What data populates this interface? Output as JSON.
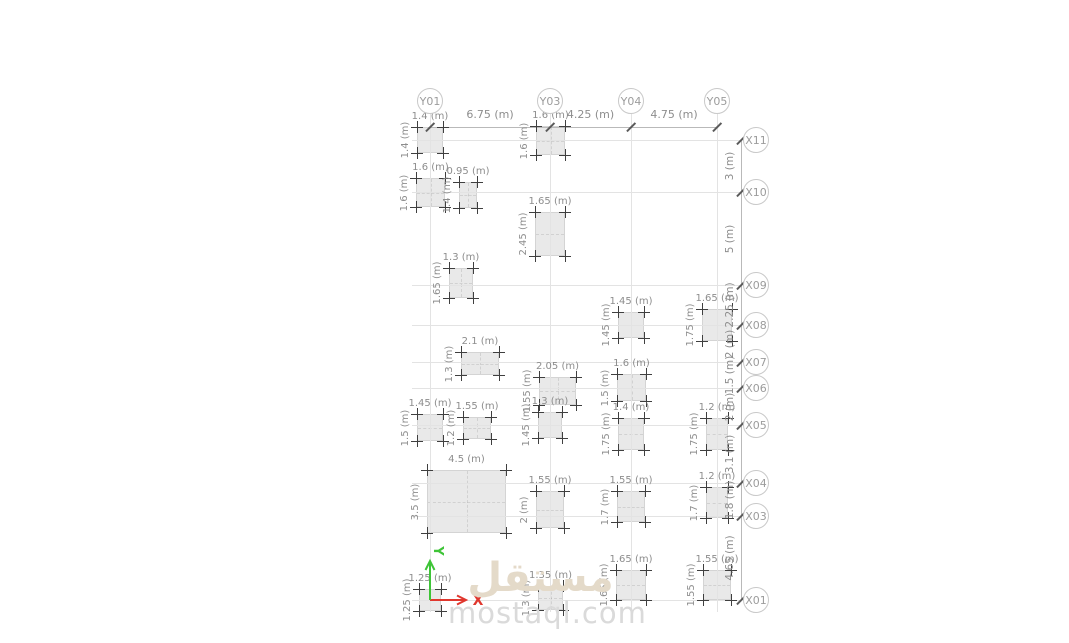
{
  "drawing": {
    "columns": [
      {
        "label": "Y01",
        "x": 430
      },
      {
        "label": "Y03",
        "x": 550
      },
      {
        "label": "Y04",
        "x": 631
      },
      {
        "label": "Y05",
        "x": 717
      }
    ],
    "rows": [
      {
        "label": "X11",
        "y": 140
      },
      {
        "label": "X10",
        "y": 192
      },
      {
        "label": "X09",
        "y": 285
      },
      {
        "label": "X08",
        "y": 325
      },
      {
        "label": "X07",
        "y": 362
      },
      {
        "label": "X06",
        "y": 388
      },
      {
        "label": "X05",
        "y": 425
      },
      {
        "label": "X04",
        "y": 483
      },
      {
        "label": "X03",
        "y": 516
      },
      {
        "label": "X01",
        "y": 600
      }
    ],
    "top_dimensions": [
      {
        "label": "6.75 (m)",
        "from_x": 430,
        "to_x": 550
      },
      {
        "label": "4.25 (m)",
        "from_x": 550,
        "to_x": 631
      },
      {
        "label": "4.75 (m)",
        "from_x": 631,
        "to_x": 717
      }
    ],
    "right_dimensions": [
      {
        "label": "3 (m)",
        "from_y": 140,
        "to_y": 192
      },
      {
        "label": "5 (m)",
        "from_y": 192,
        "to_y": 285
      },
      {
        "label": "2.25 (m)",
        "from_y": 285,
        "to_y": 325
      },
      {
        "label": "2 (m)",
        "from_y": 325,
        "to_y": 362
      },
      {
        "label": "1.5 (m)",
        "from_y": 362,
        "to_y": 388
      },
      {
        "label": "2 (m)",
        "from_y": 388,
        "to_y": 425
      },
      {
        "label": "3.1 (m)",
        "from_y": 425,
        "to_y": 483
      },
      {
        "label": "1.8 (m)",
        "from_y": 483,
        "to_y": 516
      },
      {
        "label": "4.65 (m)",
        "from_y": 516,
        "to_y": 600
      }
    ],
    "footings": [
      {
        "x": 417,
        "y": 127,
        "w": 26,
        "h": 26,
        "width_label": "1.4 (m)",
        "height_label": "1.4 (m)"
      },
      {
        "x": 536,
        "y": 126,
        "w": 29,
        "h": 29,
        "width_label": "1.6 (m)",
        "height_label": "1.6 (m)"
      },
      {
        "x": 416,
        "y": 178,
        "w": 29,
        "h": 29,
        "width_label": "1.6 (m)",
        "height_label": "1.6 (m)"
      },
      {
        "x": 459,
        "y": 182,
        "w": 18,
        "h": 26,
        "width_label": "0.95 (m)",
        "height_label": "1.4 (m)"
      },
      {
        "x": 535,
        "y": 212,
        "w": 30,
        "h": 44,
        "width_label": "1.65 (m)",
        "height_label": "2.45 (m)"
      },
      {
        "x": 449,
        "y": 268,
        "w": 24,
        "h": 30,
        "width_label": "1.3 (m)",
        "height_label": "1.65 (m)"
      },
      {
        "x": 618,
        "y": 312,
        "w": 26,
        "h": 26,
        "width_label": "1.45 (m)",
        "height_label": "1.45 (m)"
      },
      {
        "x": 702,
        "y": 309,
        "w": 30,
        "h": 32,
        "width_label": "1.65 (m)",
        "height_label": "1.75 (m)"
      },
      {
        "x": 461,
        "y": 352,
        "w": 38,
        "h": 23,
        "width_label": "2.1 (m)",
        "height_label": "1.3 (m)"
      },
      {
        "x": 539,
        "y": 377,
        "w": 37,
        "h": 28,
        "width_label": "2.05 (m)",
        "height_label": "1.55 (m)"
      },
      {
        "x": 617,
        "y": 374,
        "w": 29,
        "h": 27,
        "width_label": "1.6 (m)",
        "height_label": "1.5 (m)"
      },
      {
        "x": 417,
        "y": 414,
        "w": 26,
        "h": 27,
        "width_label": "1.45 (m)",
        "height_label": "1.5 (m)"
      },
      {
        "x": 463,
        "y": 417,
        "w": 28,
        "h": 22,
        "width_label": "1.55 (m)",
        "height_label": "1.2 (m)"
      },
      {
        "x": 538,
        "y": 412,
        "w": 24,
        "h": 26,
        "width_label": "1.3 (m)",
        "height_label": "1.45 (m)"
      },
      {
        "x": 618,
        "y": 418,
        "w": 26,
        "h": 32,
        "width_label": "1.4 (m)",
        "height_label": "1.75 (m)"
      },
      {
        "x": 706,
        "y": 418,
        "w": 22,
        "h": 32,
        "width_label": "1.2 (m)",
        "height_label": "1.75 (m)"
      },
      {
        "x": 427,
        "y": 470,
        "w": 79,
        "h": 63,
        "width_label": "4.5 (m)",
        "height_label": "3.5 (m)"
      },
      {
        "x": 536,
        "y": 491,
        "w": 28,
        "h": 37,
        "width_label": "1.55 (m)",
        "height_label": "2 (m)"
      },
      {
        "x": 617,
        "y": 491,
        "w": 28,
        "h": 31,
        "width_label": "1.55 (m)",
        "height_label": "1.7 (m)"
      },
      {
        "x": 706,
        "y": 487,
        "w": 22,
        "h": 31,
        "width_label": "1.2 (m)",
        "height_label": "1.7 (m)"
      },
      {
        "x": 419,
        "y": 589,
        "w": 22,
        "h": 22,
        "width_label": "1.25 (m)",
        "height_label": "1.25 (m)"
      },
      {
        "x": 538,
        "y": 586,
        "w": 25,
        "h": 24,
        "width_label": "1.35 (m)",
        "height_label": "1.3 (m)"
      },
      {
        "x": 616,
        "y": 570,
        "w": 30,
        "h": 30,
        "width_label": "1.65 (m)",
        "height_label": "1.65 (m)"
      },
      {
        "x": 703,
        "y": 570,
        "w": 28,
        "h": 30,
        "width_label": "1.55 (m)",
        "height_label": "1.55 (m)"
      }
    ],
    "axis_triad": {
      "x_label": "X",
      "y_label": "Y",
      "x_color": "#e0372e",
      "y_color": "#3ec437"
    },
    "watermark": {
      "arabic": "مستقل",
      "latin": "mostaql.com"
    },
    "colors": {
      "footing_fill": "#e9e9e9",
      "footing_border": "#d4d4d4",
      "grid": "#e3e3e3",
      "chain": "#b9b9b9",
      "dim_text": "#8d8d8d",
      "bubble_border": "#c9c9c9",
      "bubble_text": "#9c9c9c",
      "cross": "#3f3f3f"
    }
  }
}
